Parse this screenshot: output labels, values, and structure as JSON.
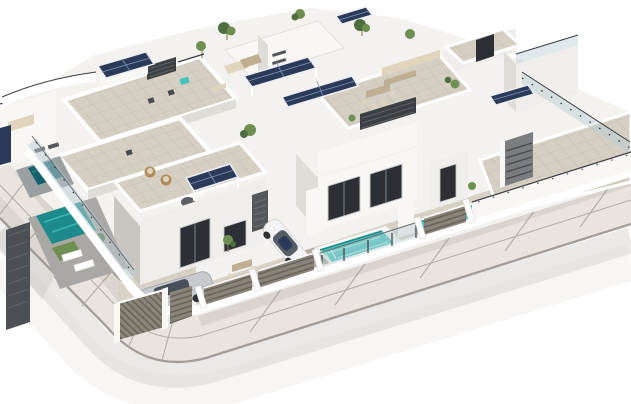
{
  "scene": {
    "title": "Aerial 3D architectural rendering of a modern white villa complex on a corner plot",
    "type": "architectural-render",
    "features": [
      "modern white two-storey villas",
      "rooftop terraces with beige tiled floors",
      "solar-panel pergolas on roofs",
      "private turquoise swimming pools with glass fences",
      "dark slatted privacy fences and driveway gates",
      "silver car and white car parked in driveways",
      "sun loungers, corner sofas, dining sets and planters",
      "curved tiled sidewalk wrapping the street corner",
      "white background"
    ]
  },
  "colors": {
    "bg": "#ffffff",
    "road": "#d8d4cd",
    "sidewalk": "#e9e5de",
    "sidewalk_joint": "#b3ada3",
    "curb": "#96908a",
    "wall_white": "#f8f7f4",
    "wall_light": "#efeeea",
    "wall_shade": "#dedcd7",
    "wall_dark": "#c8c6c1",
    "roof_tile": "#d6d0c4",
    "roof_tile_line": "#c2bbad",
    "pave": "#d9d3c7",
    "pave_line": "#c7c0b2",
    "gravel": "#b3ac9f",
    "solar": "#2b3a58",
    "solar_line": "#7e95b8",
    "solar_frame": "#eceef1",
    "pool_bright": "#43c3ba",
    "pool_light": "#93e2d8",
    "pool_deep": "#1d8b8b",
    "pool_dark": "#16616c",
    "glass": "#b9cdd2",
    "railing": "#3b3e41",
    "fence_slat": "#8b8479",
    "fence_dark": "#4c4f53",
    "green": "#6f8f52",
    "green_dark": "#4e6e3f",
    "trunk": "#8a6f4e",
    "furniture": "#e0d4bd",
    "furniture_shade": "#bfae92",
    "wicker": "#b08d5f",
    "car_silver": "#c6cacd",
    "car_white": "#f2f3f4",
    "car_glass": "#39434b",
    "shadow": "#8f8b84",
    "opening": "#2c3034"
  }
}
